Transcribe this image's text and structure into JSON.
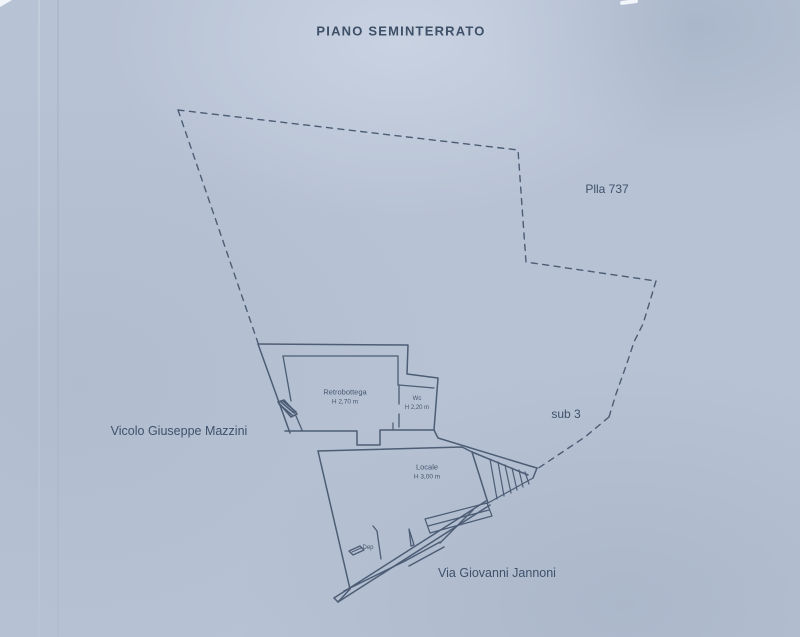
{
  "plan": {
    "title": "PIANO SEMINTERRATO",
    "parcel_label": "Plla 737",
    "sub_label": "sub 3",
    "street_left": "Vicolo Giuseppe Mazzini",
    "street_bottom": "Via Giovanni Jannoni",
    "rooms": {
      "retrobottega": {
        "name": "Retrobottega",
        "height": "H 2,70 m"
      },
      "wc": {
        "name": "Wc",
        "height": "H 2,20 m"
      },
      "locale": {
        "name": "Locale",
        "height": "H 3,00 m"
      },
      "dep": {
        "name": "Dep"
      }
    },
    "colors": {
      "paper": "#b7c2d4",
      "ink": "#4a5a73"
    }
  }
}
